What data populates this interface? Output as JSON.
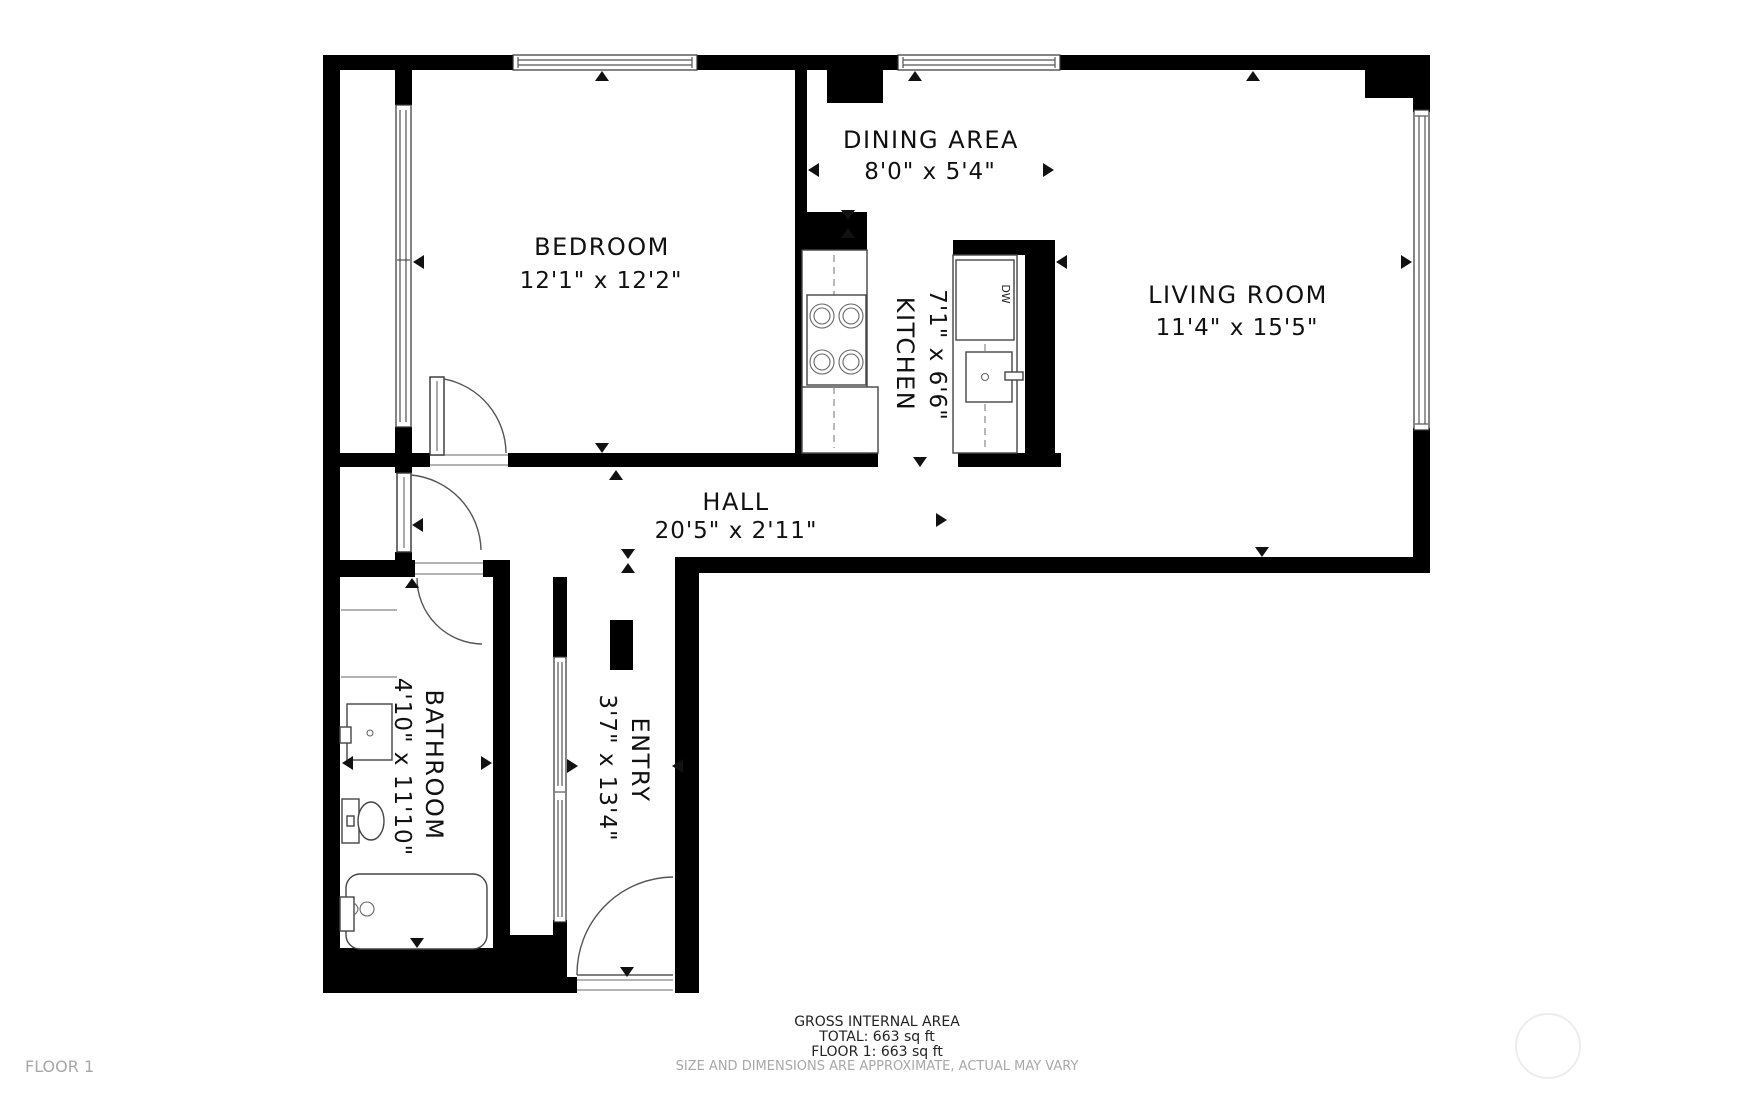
{
  "colors": {
    "wall": "#000000",
    "background": "#ffffff",
    "label_text": "#111111",
    "muted_text": "#a8a8a8",
    "window_line": "#555555",
    "fixture_line": "#444444"
  },
  "rooms": {
    "bedroom": {
      "name": "BEDROOM",
      "dimensions": "12'1\" x 12'2\""
    },
    "dining": {
      "name": "DINING AREA",
      "dimensions": "8'0\" x 5'4\""
    },
    "living": {
      "name": "LIVING ROOM",
      "dimensions": "11'4\" x 15'5\""
    },
    "kitchen": {
      "name": "KITCHEN",
      "dimensions": "7'1\" x 6'6\""
    },
    "hall": {
      "name": "HALL",
      "dimensions": "20'5\" x 2'11\""
    },
    "bathroom": {
      "name": "BATHROOM",
      "dimensions": "4'10\" x 11'10\""
    },
    "entry": {
      "name": "ENTRY",
      "dimensions": "3'7\" x 13'4\""
    }
  },
  "fixtures": {
    "dishwasher_label": "DW"
  },
  "footer": {
    "gross_label": "GROSS INTERNAL AREA",
    "total": "TOTAL: 663 sq ft",
    "floor_total": "FLOOR 1: 663 sq ft",
    "disclaimer": "SIZE AND DIMENSIONS ARE APPROXIMATE, ACTUAL MAY VARY",
    "floor_label": "FLOOR 1"
  },
  "icons": {
    "dimension_arrow": "small black triangle",
    "watermark": "faint circle"
  }
}
